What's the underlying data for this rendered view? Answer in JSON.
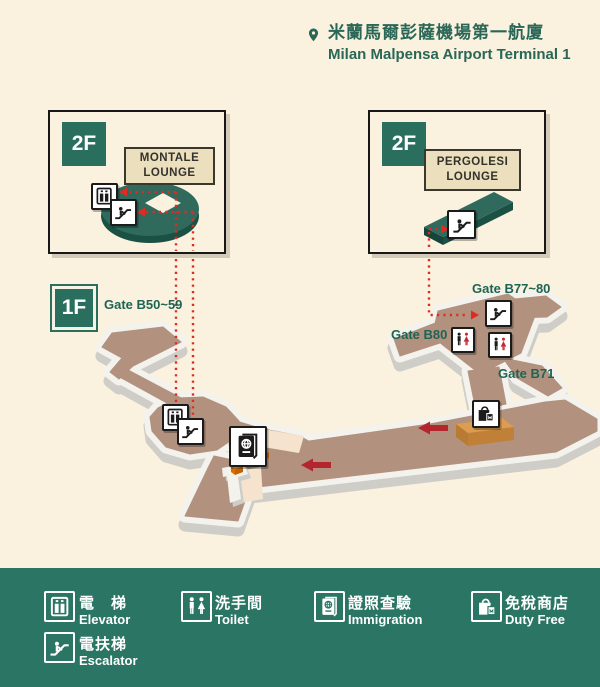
{
  "header": {
    "title_zh": "米蘭馬爾彭薩機場第一航廈",
    "title_en": "Milan Malpensa Airport Terminal 1"
  },
  "insets": {
    "left": {
      "floor": "2F",
      "lounge_line1": "MONTALE",
      "lounge_line2": "LOUNGE"
    },
    "right": {
      "floor": "2F",
      "lounge_line1": "PERGOLESI",
      "lounge_line2": "LOUNGE"
    }
  },
  "plan": {
    "floor_label": "1F",
    "gates": {
      "b50": "Gate B50~59",
      "b77": "Gate B77~80",
      "b80": "Gate B80",
      "b71": "Gate B71"
    }
  },
  "legend": {
    "items": [
      {
        "icon": "elevator-icon",
        "zh": "電　梯",
        "en": "Elevator"
      },
      {
        "icon": "escalator-icon",
        "zh": "電扶梯",
        "en": "Escalator"
      },
      {
        "icon": "toilet-icon",
        "zh": "洗手間",
        "en": "Toilet"
      },
      {
        "icon": "immigration-icon",
        "zh": "證照查驗",
        "en": "Immigration"
      },
      {
        "icon": "duty-free-icon",
        "zh": "免稅商店",
        "en": "Duty Free"
      }
    ]
  },
  "colors": {
    "background": "#FAF1DE",
    "brand_green": "#2A6E5D",
    "legend_green": "#2B7565",
    "floor_brown": "#B2927E",
    "route_red": "#E02B20",
    "arrow_red": "#B3262E",
    "counter_orange": "#F6921E"
  }
}
